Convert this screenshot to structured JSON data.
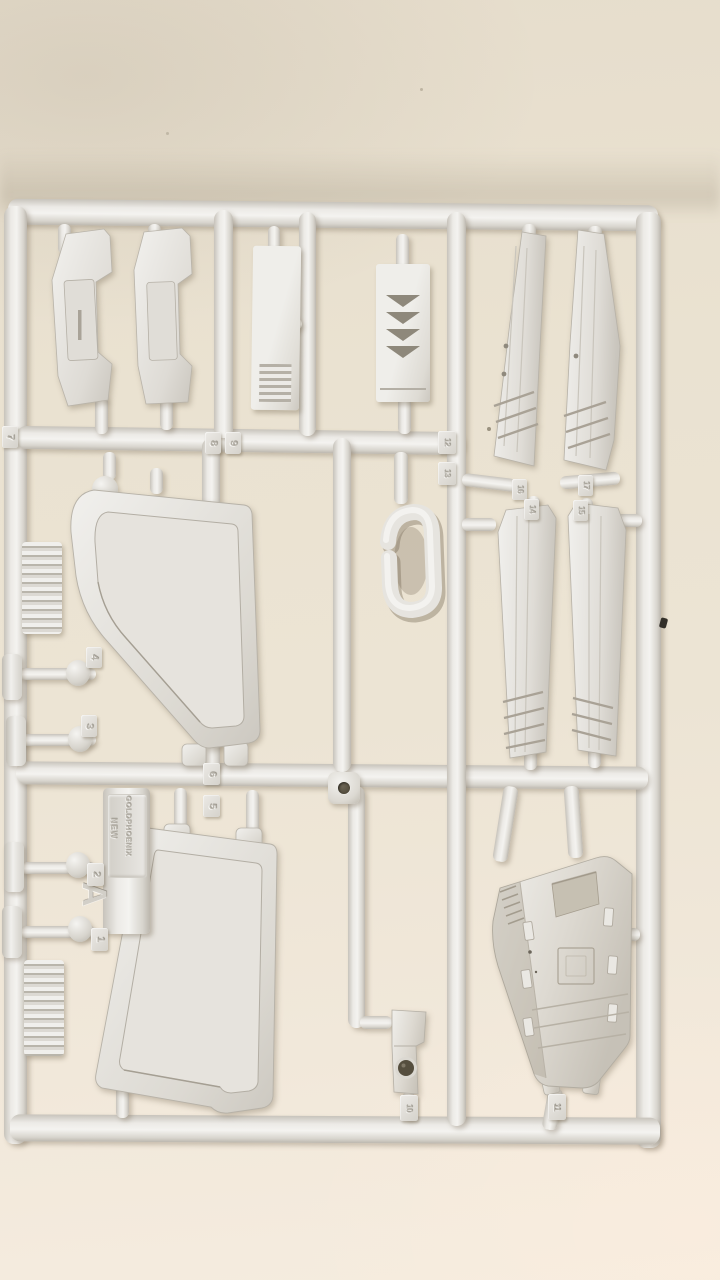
{
  "scene": {
    "subject": "white injection-molded plastic model kit sprue (runner) photographed on a beige table"
  },
  "sprue": {
    "runner_letter": "A",
    "brand": {
      "word1": "NEW",
      "word2": "GOLDPHOENIX"
    },
    "part_tags": {
      "n1": "1",
      "n2": "2",
      "n3": "3",
      "n4": "4",
      "n5": "5",
      "n6": "6",
      "n7": "7",
      "n8": "8",
      "n9": "9",
      "n10": "10",
      "n11": "11",
      "n12": "12",
      "n13": "13",
      "n14": "14",
      "n15": "15",
      "n16": "16",
      "n17": "17"
    }
  },
  "colors": {
    "background_top": "#e7dfcf",
    "background_bottom": "#f5ecdf",
    "plastic_light": "#f4f3f0",
    "plastic_base": "#e4e2dd",
    "plastic_shadow": "#b7b2a8",
    "cast_shadow": "rgba(122,109,88,0.35)",
    "emboss_text": "#b6b2a9",
    "arrow_notch": "#8e887b",
    "hole_dark": "#554e3e",
    "debris": "#33302a"
  }
}
